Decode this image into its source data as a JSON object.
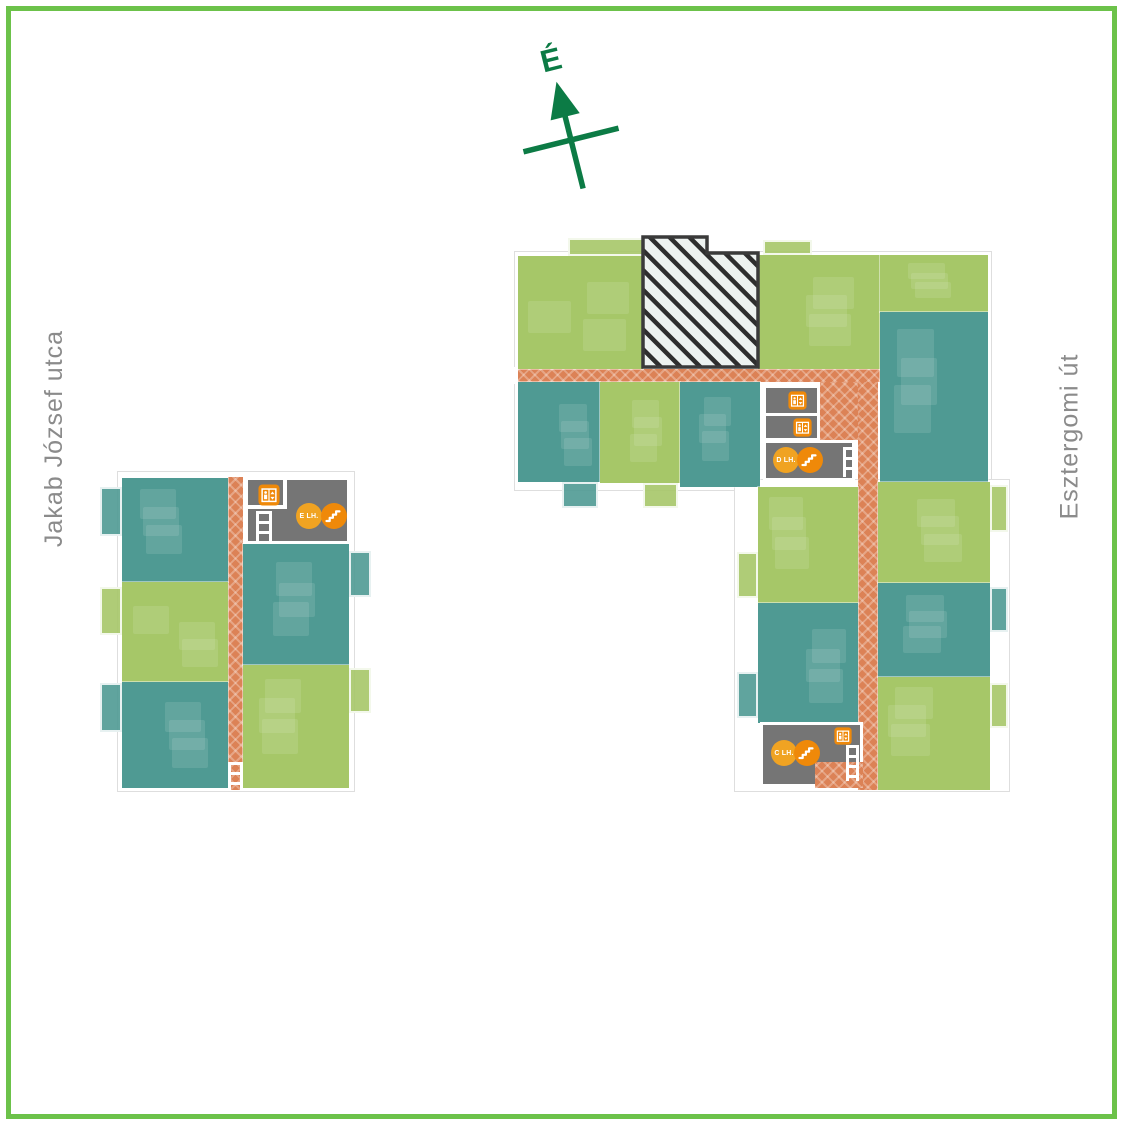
{
  "frame": {
    "border_color": "#6cc24a"
  },
  "compass": {
    "label": "É",
    "color": "#0c7b45"
  },
  "streets": {
    "color": "#8b8b8b",
    "left": {
      "label": "Jakab József utca"
    },
    "right": {
      "label": "Esztergomi út"
    }
  },
  "palette": {
    "green_unit": "#a6c768",
    "teal_unit": "#4f9a93",
    "corridor": "#dc8256",
    "core": "#757575",
    "icon_orange": "#ef8909",
    "icon_amber": "#f0a322",
    "hatch_bg": "#edf2f0",
    "hatch_line": "#2e2e2e",
    "hatch_border": "#3a3a3a"
  },
  "hatch": {
    "points": "643,237 707,237 707,253 758,253 758,367 643,367"
  },
  "staircase_labels": [
    "E LH.",
    "D LH.",
    "C LH."
  ],
  "plan_elements": [
    {
      "kind": "outline",
      "x": 117,
      "y": 471,
      "w": 238,
      "h": 321
    },
    {
      "kind": "outline",
      "x": 514,
      "y": 251,
      "w": 478,
      "h": 240
    },
    {
      "kind": "outline",
      "x": 734,
      "y": 479,
      "w": 276,
      "h": 313
    },
    {
      "kind": "corridor",
      "x": 228,
      "y": 477,
      "w": 15,
      "h": 313
    },
    {
      "kind": "corridor",
      "x": 518,
      "y": 369,
      "w": 362,
      "h": 13
    },
    {
      "kind": "corridor",
      "x": 858,
      "y": 382,
      "w": 20,
      "h": 408
    },
    {
      "kind": "corridor",
      "x": 820,
      "y": 382,
      "w": 38,
      "h": 58
    },
    {
      "kind": "unit",
      "color": "teal",
      "x": 122,
      "y": 478,
      "w": 106,
      "h": 104
    },
    {
      "kind": "unit",
      "color": "green",
      "x": 122,
      "y": 582,
      "w": 106,
      "h": 100
    },
    {
      "kind": "unit",
      "color": "teal",
      "x": 122,
      "y": 682,
      "w": 106,
      "h": 106
    },
    {
      "kind": "unit",
      "color": "teal",
      "x": 243,
      "y": 544,
      "w": 106,
      "h": 121
    },
    {
      "kind": "unit",
      "color": "green",
      "x": 243,
      "y": 665,
      "w": 106,
      "h": 123
    },
    {
      "kind": "unit",
      "color": "green",
      "x": 518,
      "y": 256,
      "w": 125,
      "h": 113
    },
    {
      "kind": "unit",
      "color": "green",
      "x": 758,
      "y": 255,
      "w": 122,
      "h": 114
    },
    {
      "kind": "unit",
      "color": "green",
      "x": 880,
      "y": 255,
      "w": 108,
      "h": 57
    },
    {
      "kind": "unit",
      "color": "teal",
      "x": 880,
      "y": 312,
      "w": 108,
      "h": 170
    },
    {
      "kind": "unit",
      "color": "teal",
      "x": 518,
      "y": 382,
      "w": 82,
      "h": 100
    },
    {
      "kind": "unit",
      "color": "green",
      "x": 600,
      "y": 382,
      "w": 80,
      "h": 101
    },
    {
      "kind": "unit",
      "color": "teal",
      "x": 680,
      "y": 382,
      "w": 80,
      "h": 105
    },
    {
      "kind": "unit",
      "color": "green",
      "x": 758,
      "y": 487,
      "w": 100,
      "h": 116
    },
    {
      "kind": "unit",
      "color": "teal",
      "x": 758,
      "y": 603,
      "w": 100,
      "h": 120
    },
    {
      "kind": "unit",
      "color": "green",
      "x": 878,
      "y": 482,
      "w": 112,
      "h": 101
    },
    {
      "kind": "unit",
      "color": "teal",
      "x": 878,
      "y": 583,
      "w": 112,
      "h": 94
    },
    {
      "kind": "unit",
      "color": "green",
      "x": 878,
      "y": 677,
      "w": 112,
      "h": 113
    },
    {
      "kind": "balcony",
      "color": "teal",
      "x": 100,
      "y": 487,
      "w": 22,
      "h": 49
    },
    {
      "kind": "balcony",
      "color": "green",
      "x": 100,
      "y": 587,
      "w": 22,
      "h": 48
    },
    {
      "kind": "balcony",
      "color": "teal",
      "x": 100,
      "y": 683,
      "w": 22,
      "h": 49
    },
    {
      "kind": "balcony",
      "color": "teal",
      "x": 349,
      "y": 551,
      "w": 22,
      "h": 46
    },
    {
      "kind": "balcony",
      "color": "green",
      "x": 349,
      "y": 668,
      "w": 22,
      "h": 45
    },
    {
      "kind": "balcony",
      "color": "green",
      "x": 568,
      "y": 238,
      "w": 77,
      "h": 18
    },
    {
      "kind": "balcony",
      "color": "green",
      "x": 763,
      "y": 240,
      "w": 49,
      "h": 15
    },
    {
      "kind": "balcony",
      "color": "teal",
      "x": 562,
      "y": 482,
      "w": 36,
      "h": 26
    },
    {
      "kind": "balcony",
      "color": "green",
      "x": 643,
      "y": 483,
      "w": 35,
      "h": 25
    },
    {
      "kind": "balcony",
      "color": "green",
      "x": 737,
      "y": 552,
      "w": 21,
      "h": 46
    },
    {
      "kind": "balcony",
      "color": "teal",
      "x": 737,
      "y": 672,
      "w": 21,
      "h": 46
    },
    {
      "kind": "balcony",
      "color": "green",
      "x": 990,
      "y": 485,
      "w": 18,
      "h": 47
    },
    {
      "kind": "balcony",
      "color": "teal",
      "x": 990,
      "y": 587,
      "w": 18,
      "h": 45
    },
    {
      "kind": "balcony",
      "color": "green",
      "x": 990,
      "y": 683,
      "w": 18,
      "h": 45
    },
    {
      "kind": "core",
      "x": 245,
      "y": 477,
      "w": 105,
      "h": 67
    },
    {
      "kind": "core",
      "x": 763,
      "y": 385,
      "w": 57,
      "h": 56
    },
    {
      "kind": "core",
      "x": 763,
      "y": 440,
      "w": 92,
      "h": 41
    },
    {
      "kind": "core",
      "x": 760,
      "y": 722,
      "w": 103,
      "h": 65
    },
    {
      "kind": "corridor",
      "x": 815,
      "y": 762,
      "w": 48,
      "h": 26
    },
    {
      "kind": "wall",
      "x": 283,
      "y": 480,
      "w": 4,
      "h": 28
    },
    {
      "kind": "wall",
      "x": 247,
      "y": 505,
      "w": 40,
      "h": 4
    },
    {
      "kind": "wall",
      "x": 765,
      "y": 413,
      "w": 53,
      "h": 3
    },
    {
      "kind": "wall",
      "x": 509,
      "y": 367,
      "w": 9,
      "h": 17
    },
    {
      "kind": "ladder",
      "x": 256,
      "y": 511,
      "w": 16,
      "h": 32
    },
    {
      "kind": "ladder",
      "x": 228,
      "y": 762,
      "w": 15,
      "h": 28
    },
    {
      "kind": "ladder",
      "x": 843,
      "y": 447,
      "w": 13,
      "h": 30
    },
    {
      "kind": "ladder",
      "x": 846,
      "y": 745,
      "w": 13,
      "h": 36
    },
    {
      "kind": "elevator",
      "x": 258,
      "y": 484,
      "s": 22
    },
    {
      "kind": "elevator",
      "x": 788,
      "y": 391,
      "s": 19
    },
    {
      "kind": "elevator",
      "x": 793,
      "y": 418,
      "s": 19
    },
    {
      "kind": "elevator",
      "x": 834,
      "y": 727,
      "s": 18
    },
    {
      "kind": "badge",
      "label": "E LH.",
      "cx": 309,
      "cy": 516,
      "r": 13
    },
    {
      "kind": "stairs",
      "cx": 334,
      "cy": 516,
      "r": 13
    },
    {
      "kind": "badge",
      "label": "D LH.",
      "cx": 786,
      "cy": 460,
      "r": 13
    },
    {
      "kind": "stairs",
      "cx": 810,
      "cy": 460,
      "r": 13
    },
    {
      "kind": "badge",
      "label": "C LH.",
      "cx": 784,
      "cy": 753,
      "r": 13
    },
    {
      "kind": "stairs",
      "cx": 807,
      "cy": 753,
      "r": 13
    }
  ]
}
